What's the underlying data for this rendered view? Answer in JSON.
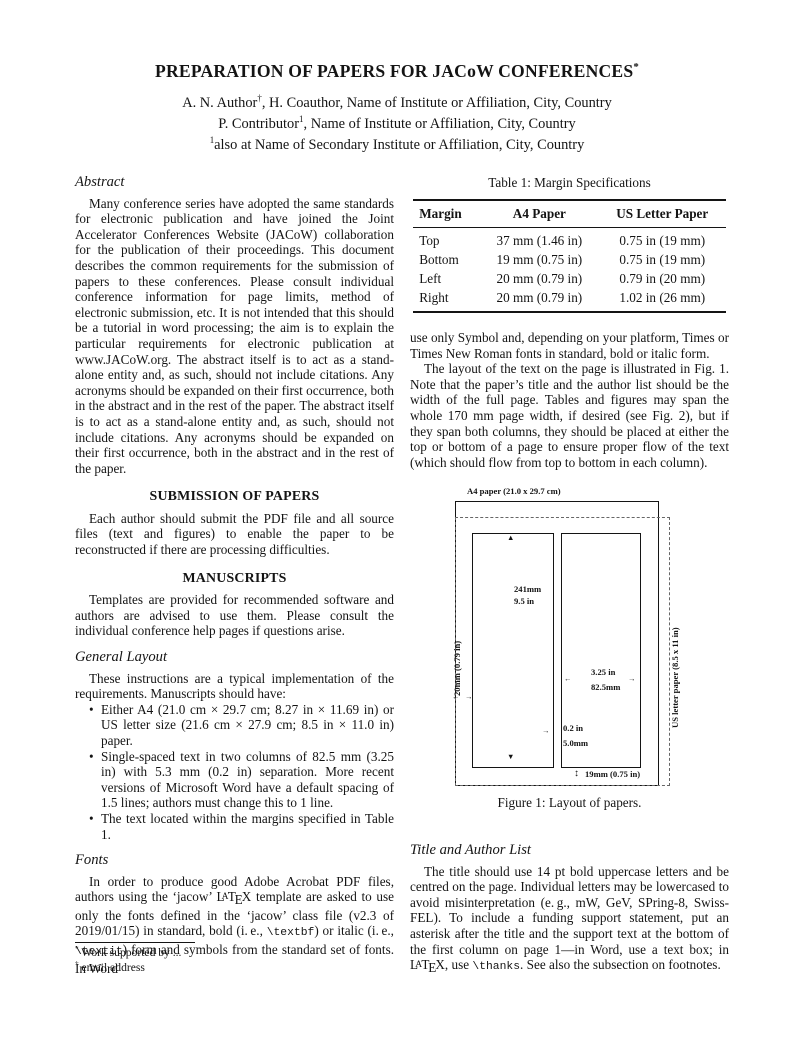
{
  "colors": {
    "page_bg": "#ffffff",
    "text": "#141414"
  },
  "header": {
    "title_segments": [
      {
        "t": "PREPARATION OF PAPERS FOR JACoW CONFERENCES",
        "s": "n"
      },
      {
        "t": "*",
        "s": "sup"
      }
    ],
    "author_lines": [
      [
        {
          "t": "A. N. Author",
          "s": "n"
        },
        {
          "t": "†",
          "s": "sup"
        },
        {
          "t": ", H. Coauthor, Name of Institute or Affiliation, City, Country",
          "s": "n"
        }
      ],
      [
        {
          "t": "P. Contributor",
          "s": "n"
        },
        {
          "t": "1",
          "s": "sup"
        },
        {
          "t": ", Name of Institute or Affiliation, City, Country",
          "s": "n"
        }
      ],
      [
        {
          "t": "1",
          "s": "sup"
        },
        {
          "t": "also at Name of Secondary Institute or Affiliation, City, Country",
          "s": "n"
        }
      ]
    ]
  },
  "left": {
    "abstract_heading": "Abstract",
    "abstract_text": "Many conference series have adopted the same standards for electronic publication and have joined the Joint Accelerator Conferences Website (JACoW) collaboration for the publication of their proceedings. This document describes the common requirements for the submission of papers to these conferences. Please consult individual conference information for page limits, method of electronic submission, etc. It is not intended that this should be a tutorial in word processing; the aim is to explain the particular requirements for electronic publication at www.JACoW.org. The abstract itself is to act as a stand-alone entity and, as such, should not include citations. Any acronyms should be expanded on their first occurrence, both in the abstract and in the rest of the paper. The abstract itself is to act as a stand-alone entity and, as such, should not include citations. Any acronyms should be expanded on their first occurrence, both in the abstract and in the rest of the paper.",
    "submission_heading": "SUBMISSION OF PAPERS",
    "submission_text": "Each author should submit the PDF file and all source files (text and figures) to enable the paper to be reconstructed if there are processing difficulties.",
    "manuscripts_heading": "MANUSCRIPTS",
    "manuscripts_text": "Templates are provided for recommended software and authors are advised to use them. Please consult the individual conference help pages if questions arise.",
    "general_layout_heading": "General Layout",
    "general_layout_intro": "These instructions are a typical implementation of the requirements. Manuscripts should have:",
    "bullets": [
      "Either A4 (21.0 cm × 29.7 cm; 8.27 in × 11.69 in) or US letter size (21.6 cm × 27.9 cm; 8.5 in × 11.0 in) paper.",
      "Single-spaced text in two columns of 82.5 mm (3.25 in) with 5.3 mm (0.2 in) separation. More recent versions of Microsoft Word have a default spacing of 1.5 lines; authors must change this to 1 line.",
      "The text located within the margins specified in Table 1."
    ],
    "fonts_heading": "Fonts",
    "fonts_segments": [
      {
        "t": "In order to produce good Adobe Acrobat PDF files, authors using the ‘jacow’ ",
        "s": "n"
      },
      {
        "t": "LaTeX",
        "s": "latex"
      },
      {
        "t": " template are asked to use only the fonts defined in the ‘jacow’ class file (v2.3 of 2019/01/15) in standard, bold (i. e., ",
        "s": "n"
      },
      {
        "t": "\\textbf",
        "s": "m"
      },
      {
        "t": ") or italic (i. e., ",
        "s": "n"
      },
      {
        "t": "\\textit",
        "s": "m"
      },
      {
        "t": ") form and symbols from the standard set of fonts. In Word",
        "s": "n"
      }
    ],
    "footnotes": [
      {
        "marker": "*",
        "text": "Work supported by ..."
      },
      {
        "marker": "†",
        "text": "email address"
      }
    ]
  },
  "right": {
    "table": {
      "caption": "Table 1: Margin Specifications",
      "headers": [
        "Margin",
        "A4 Paper",
        "US Letter Paper"
      ],
      "rows": [
        [
          "Top",
          "37 mm (1.46 in)",
          "0.75 in (19 mm)"
        ],
        [
          "Bottom",
          "19 mm (0.75 in)",
          "0.75 in (19 mm)"
        ],
        [
          "Left",
          "20 mm (0.79 in)",
          "0.79 in (20 mm)"
        ],
        [
          "Right",
          "20 mm (0.79 in)",
          "1.02 in (26 mm)"
        ]
      ]
    },
    "para1": "use only Symbol and, depending on your platform, Times or Times New Roman fonts in standard, bold or italic form.",
    "para2": "The layout of the text on the page is illustrated in Fig. 1. Note that the paper’s title and the author list should be the width of the full page. Tables and figures may span the whole 170 mm page width, if desired (see Fig. 2), but if they span both columns, they should be placed at either the top or bottom of a page to ensure proper flow of the text (which should flow from top to bottom in each column).",
    "figure": {
      "a4_label": "A4 paper (21.0 x 29.7 cm)",
      "col_height": [
        "241mm",
        "9.5 in"
      ],
      "left_margin": "20mm (0.79 in)",
      "col_width": [
        "3.25 in",
        "82.5mm"
      ],
      "col_sep": [
        "0.2 in",
        "5.0mm"
      ],
      "bottom_margin": "19mm (0.75 in)",
      "us_letter_label": "US letter paper (8.5 x 11 in)",
      "caption": "Figure 1: Layout of papers."
    },
    "title_author_heading": "Title and Author List",
    "title_author_segments": [
      {
        "t": "The title should use 14 pt bold uppercase letters and be centred on the page. Individual letters may be lowercased to avoid misinterpretation (e. g., mW, GeV, SPring-8, Swiss-FEL). To include a funding support statement, put an asterisk after the title and the support text at the bottom of the first column on page 1—in Word, use a text box; in ",
        "s": "n"
      },
      {
        "t": "LaTeX",
        "s": "latex"
      },
      {
        "t": ", use ",
        "s": "n"
      },
      {
        "t": "\\thanks",
        "s": "m"
      },
      {
        "t": ". See also the subsection on footnotes.",
        "s": "n"
      }
    ]
  }
}
